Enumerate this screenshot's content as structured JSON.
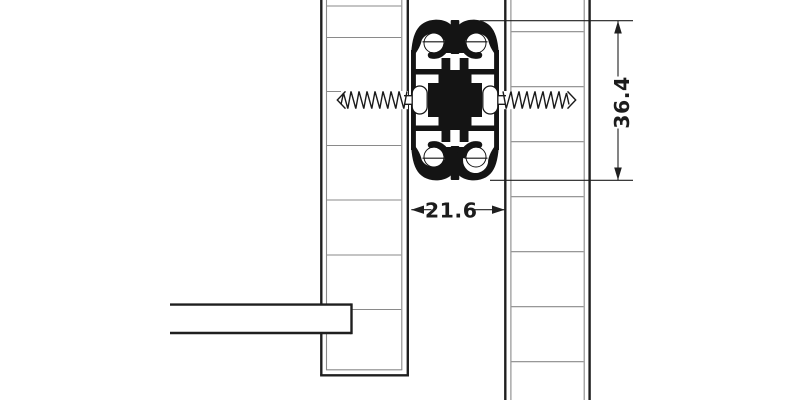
{
  "diagram": {
    "dimensions": {
      "height_label": "36.4",
      "width_label": "21.6"
    },
    "colors": {
      "line": "#1f1f1f",
      "thin_line": "#8a8a8a",
      "profile": "#141414",
      "background": "#ffffff"
    }
  }
}
